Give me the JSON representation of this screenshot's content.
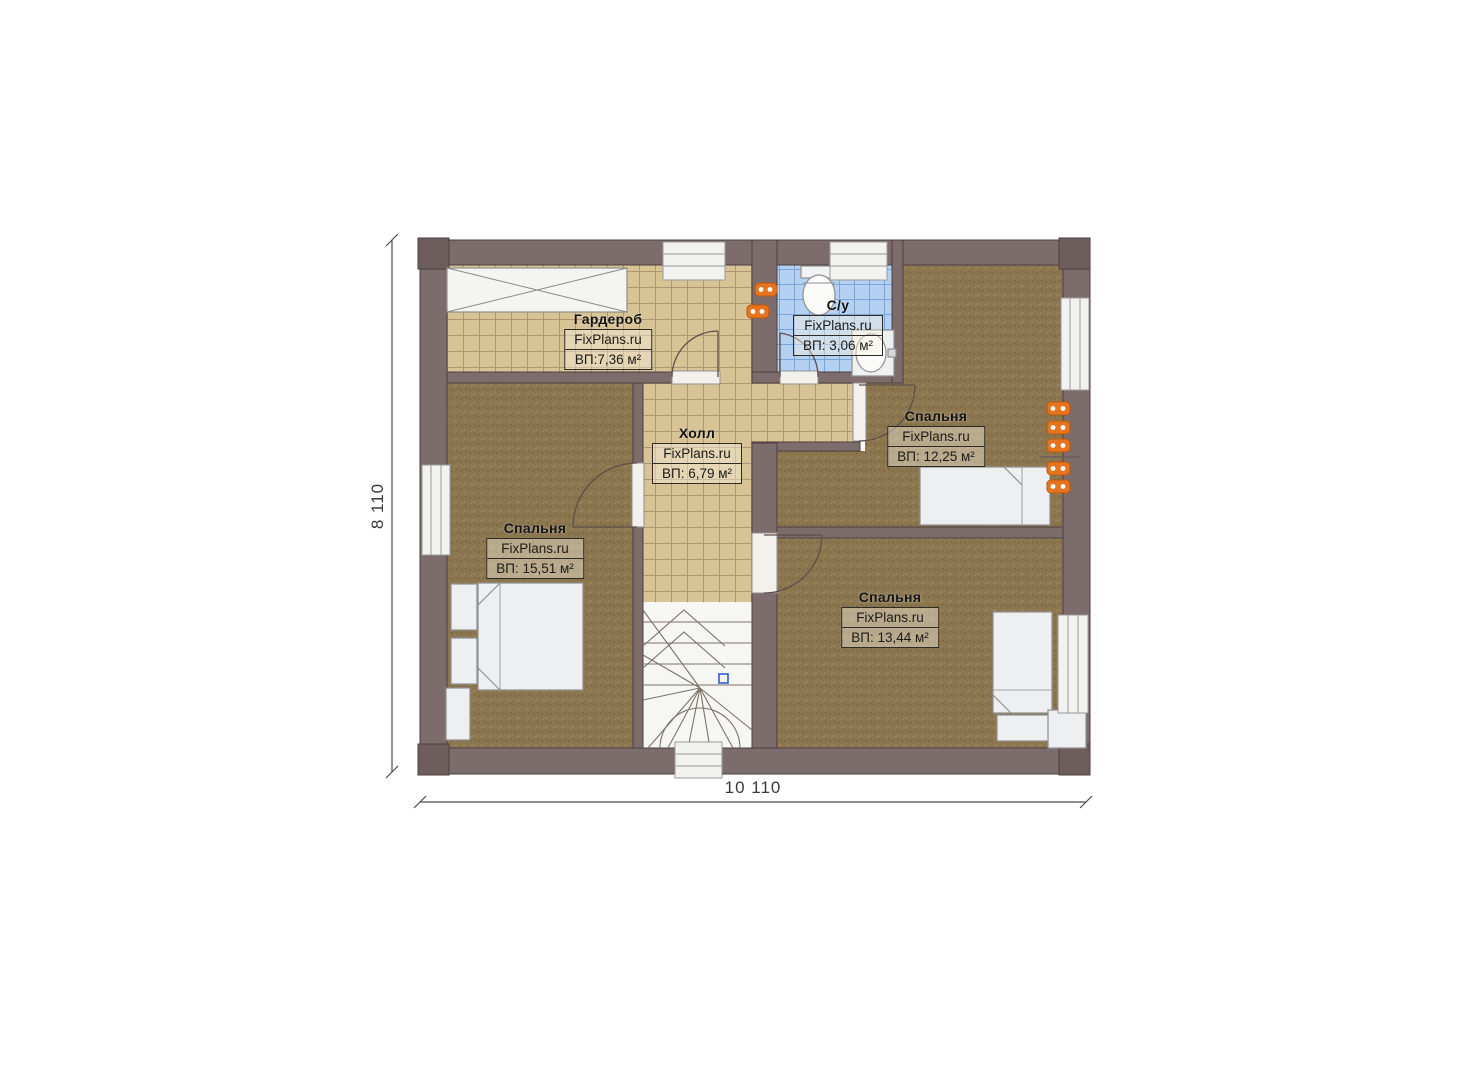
{
  "plan": {
    "type": "floor-plan",
    "dimensions": {
      "width_label": "10 110",
      "height_label": "8 110"
    },
    "rooms": [
      {
        "id": "wardrobe",
        "name": "Гардероб",
        "watermark": "FixPlans.ru",
        "area": "ВП:7,36 м²"
      },
      {
        "id": "bathroom",
        "name": "С/у",
        "watermark": "FixPlans.ru",
        "area": "ВП: 3,06 м²"
      },
      {
        "id": "bedroom-top-right",
        "name": "Спальня",
        "watermark": "FixPlans.ru",
        "area": "ВП: 12,25 м²"
      },
      {
        "id": "hall",
        "name": "Холл",
        "watermark": "FixPlans.ru",
        "area": "ВП: 6,79 м²"
      },
      {
        "id": "bedroom-left",
        "name": "Спальня",
        "watermark": "FixPlans.ru",
        "area": "ВП: 15,51 м²"
      },
      {
        "id": "bedroom-bottom-right",
        "name": "Спальня",
        "watermark": "FixPlans.ru",
        "area": "ВП: 13,44 м²"
      }
    ],
    "colors": {
      "wall": "#7d6c6c",
      "wall_outline": "#4d3f3f",
      "tile_floor": "#d8c394",
      "tile_grid": "#ad9770",
      "carpet_floor": "#8c7650",
      "bath_tile": "#b5d1f1",
      "bath_grid": "#79a5d8",
      "furniture": "#edeff0",
      "radiator": "#e8731e",
      "stair_marker": "#2b5fd0"
    }
  }
}
